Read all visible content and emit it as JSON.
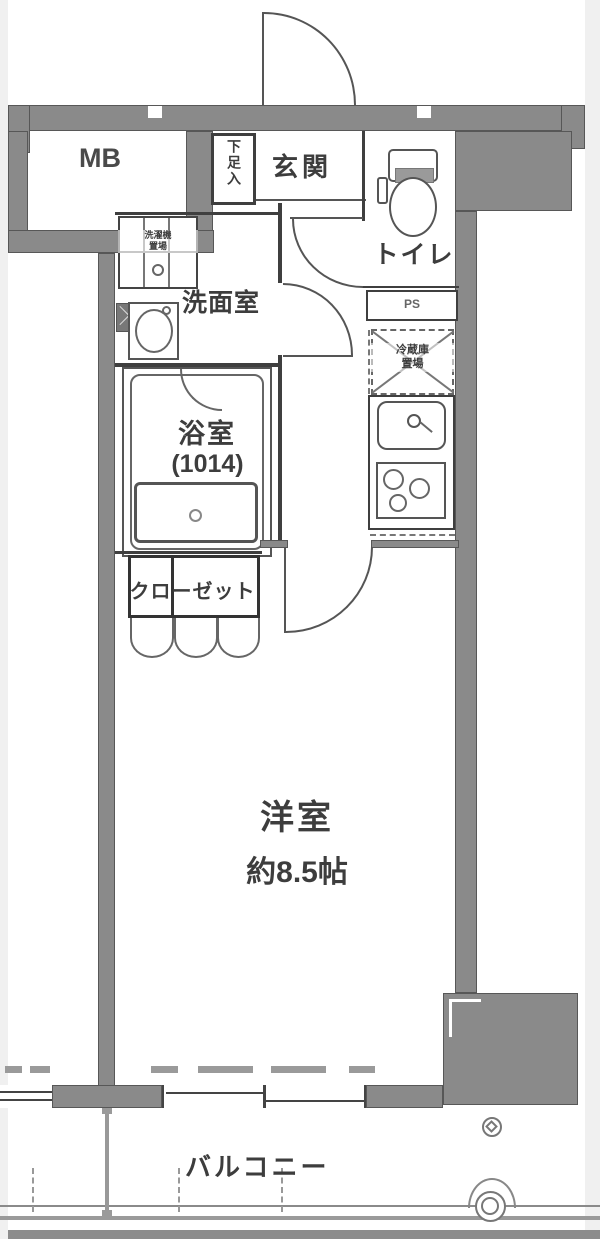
{
  "plan": {
    "rooms": {
      "mb": "MB",
      "shoe_storage": "下足入",
      "entrance": "玄関",
      "toilet": "トイレ",
      "pipe_space": "PS",
      "refrigerator_line1": "冷蔵庫",
      "refrigerator_line2": "置場",
      "laundry_line1": "洗濯機",
      "laundry_line2": "置場",
      "washroom": "洗面室",
      "bathroom": "浴室",
      "bathroom_size": "(1014)",
      "closet": "クローゼット",
      "main_room": "洋室",
      "main_room_size": "約8.5帖",
      "balcony": "バルコニー"
    },
    "colors": {
      "wall": "#8a8a8a",
      "wall_outline": "#575757",
      "line": "#555555",
      "text": "#3d3d3d",
      "background": "#ffffff",
      "margin": "#f0f0f0"
    }
  }
}
